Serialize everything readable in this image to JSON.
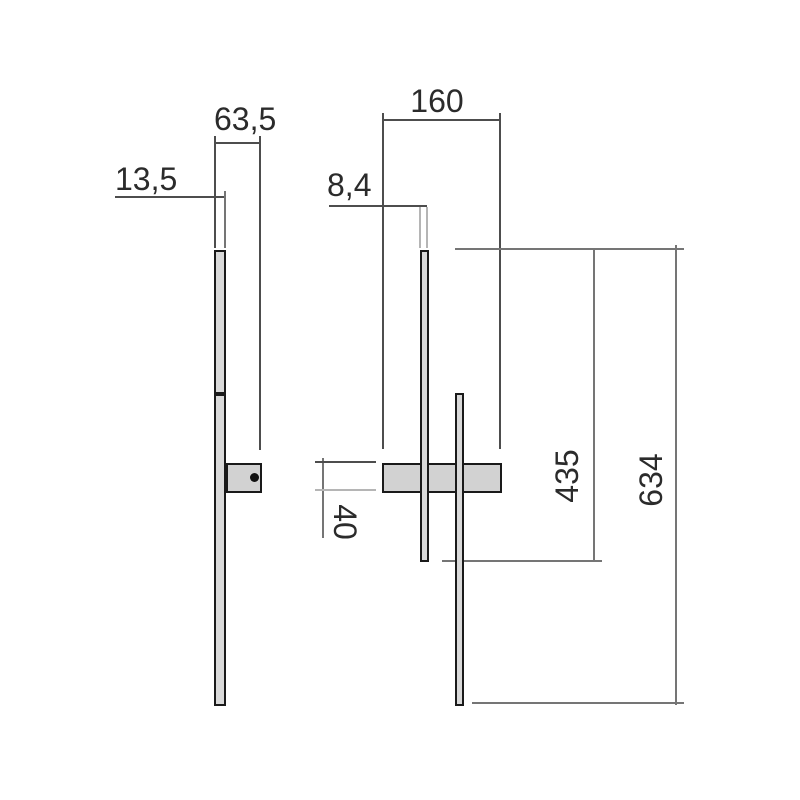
{
  "drawing_title": "wall-lamp-dimension-drawing",
  "dimensions": {
    "side_total_depth": "63,5",
    "side_bar_depth": "13,5",
    "front_bracket_width": "160",
    "front_bar_width": "8,4",
    "bracket_height": "40",
    "upper_bar_length": "435",
    "total_height": "634"
  },
  "colors": {
    "background": "#ffffff",
    "part_outline": "#1a1a1a",
    "part_fill": "#d9d9d9",
    "bracket_fill": "#d2d2d2",
    "dim_line_dark": "#4d4d4d",
    "dim_line_medium": "#757575",
    "dim_line_light": "#b5b5b5",
    "dim_text": "#2b2b2b"
  },
  "views": {
    "side_view": "lamp side profile with wall bracket and fixing screw",
    "front_view": "two offset vertical light bars crossing wall-mount bracket"
  }
}
